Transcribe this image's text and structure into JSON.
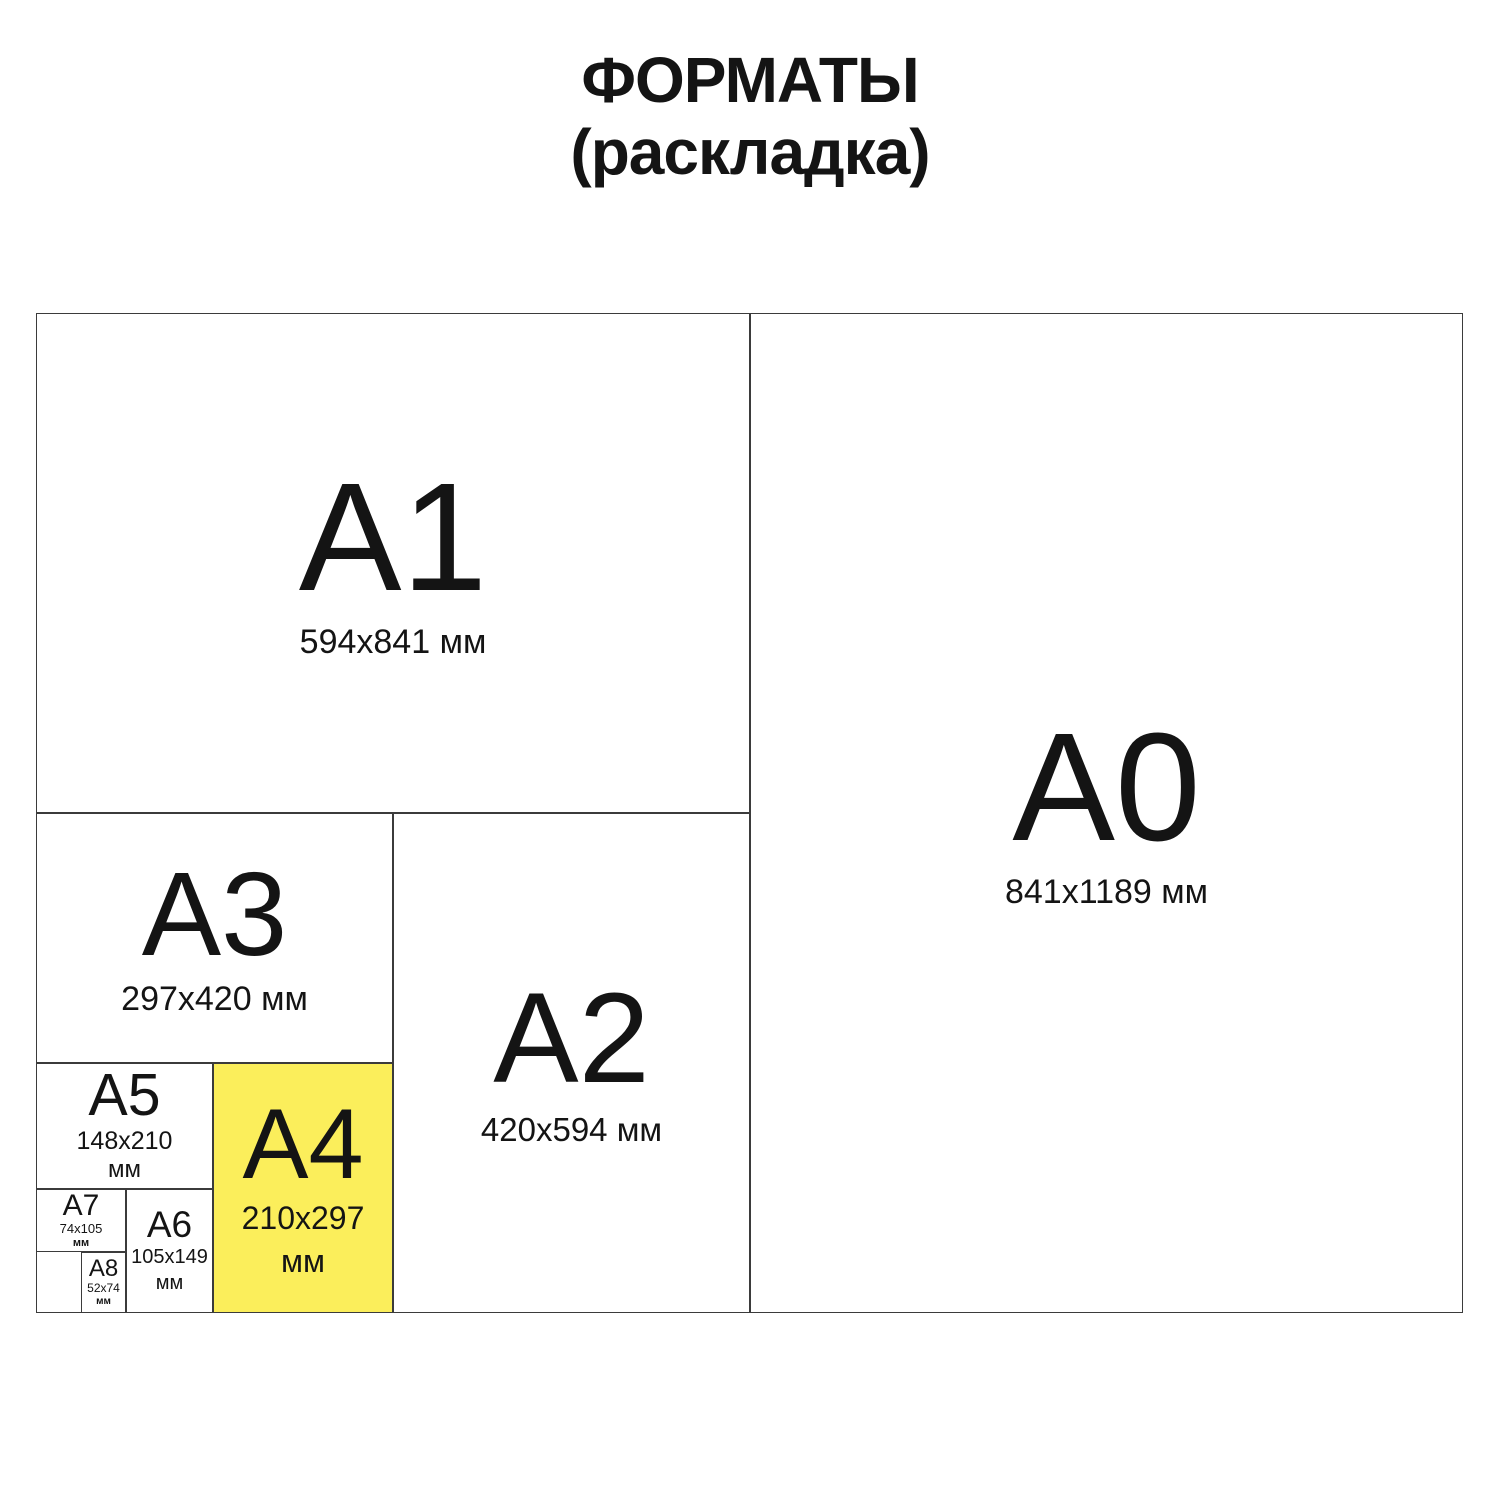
{
  "title": {
    "line1": "ФОРМАТЫ",
    "line2": "(раскладка)"
  },
  "colors": {
    "highlight": "#FBEE5B",
    "border": "#3B3B3B",
    "text": "#141414",
    "background": "#FFFFFF"
  },
  "formats": {
    "a0": {
      "label": "A0",
      "size": "841x1189 мм"
    },
    "a1": {
      "label": "A1",
      "size": "594x841 мм"
    },
    "a2": {
      "label": "A2",
      "size": "420x594 мм"
    },
    "a3": {
      "label": "A3",
      "size": "297x420 мм"
    },
    "a4": {
      "label": "A4",
      "size": "210x297",
      "unit": "мм",
      "highlighted": true
    },
    "a5": {
      "label": "A5",
      "size": "148x210",
      "unit": "мм"
    },
    "a6": {
      "label": "A6",
      "size": "105x149",
      "unit": "мм"
    },
    "a7": {
      "label": "A7",
      "size": "74x105",
      "unit": "мм"
    },
    "a8": {
      "label": "A8",
      "size": "52x74",
      "unit": "мм"
    }
  }
}
